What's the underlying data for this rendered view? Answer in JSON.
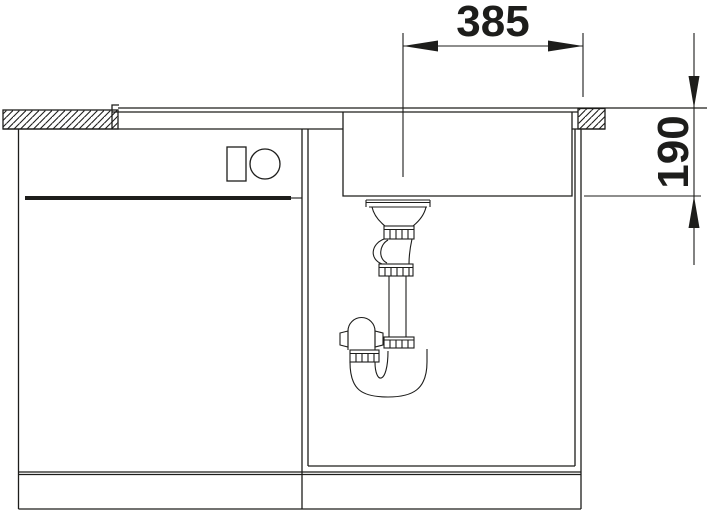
{
  "diagram": {
    "labels": {
      "width_dim": "385",
      "depth_dim": "190"
    },
    "colors": {
      "line": "#1d1d1b",
      "background": "#ffffff"
    }
  }
}
